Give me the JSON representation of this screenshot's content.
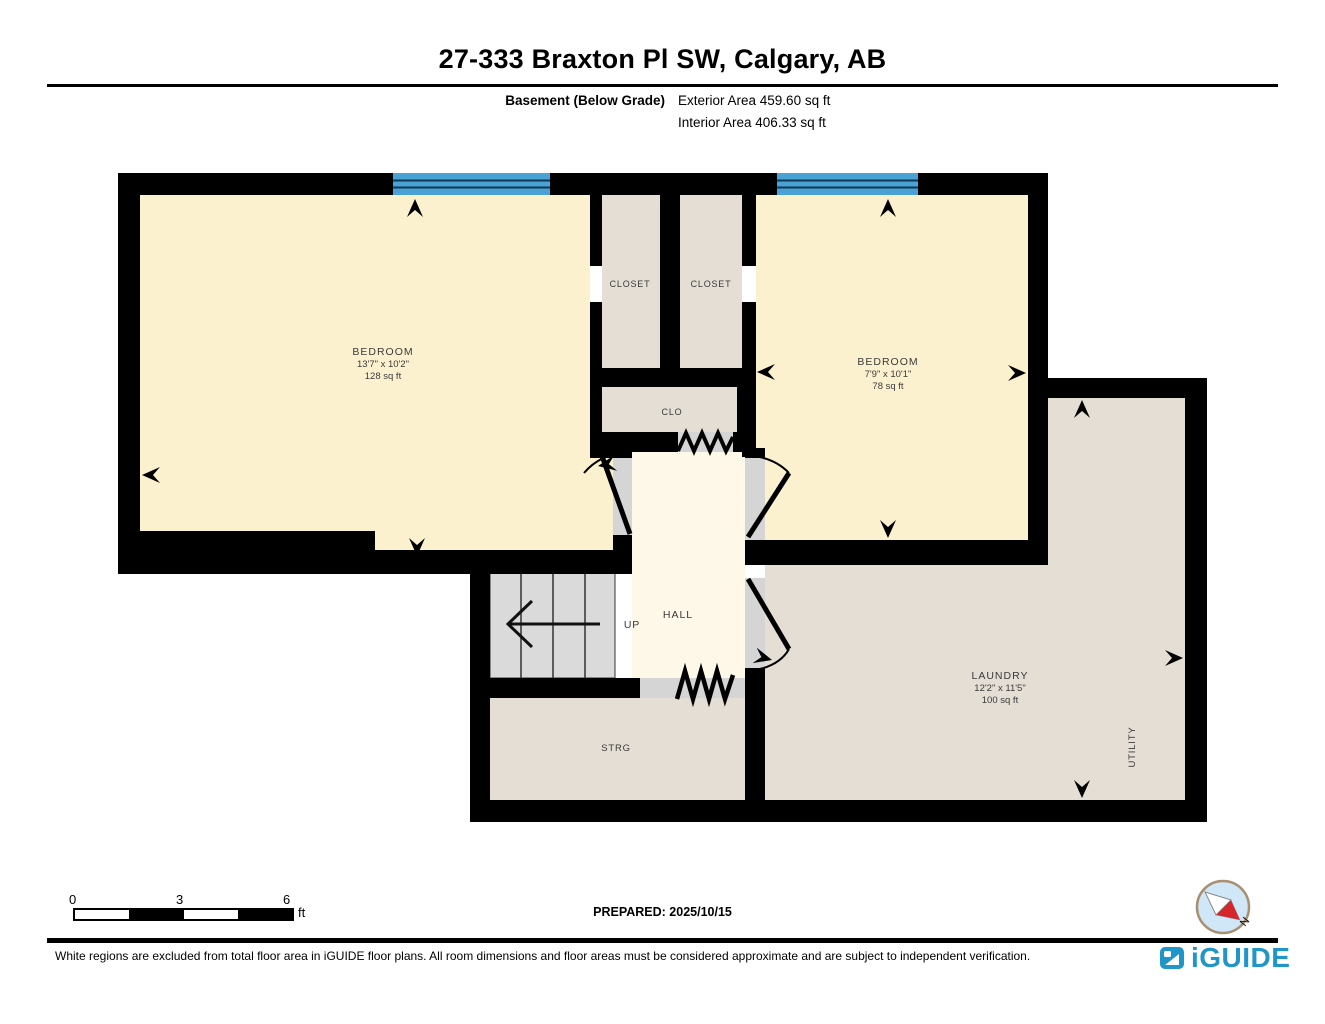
{
  "header": {
    "title": "27-333 Braxton Pl SW, Calgary, AB",
    "floor_label": "Basement (Below Grade)",
    "exterior_area": "Exterior Area 459.60 sq ft",
    "interior_area": "Interior Area 406.33 sq ft"
  },
  "rooms": {
    "bedroom1": {
      "name": "BEDROOM",
      "dimensions": "13'7\" x 10'2\"",
      "area": "128 sq ft"
    },
    "bedroom2": {
      "name": "BEDROOM",
      "dimensions": "7'9\" x 10'1\"",
      "area": "78 sq ft"
    },
    "closet1": {
      "name": "CLOSET"
    },
    "closet2": {
      "name": "CLOSET"
    },
    "clo": {
      "name": "CLO"
    },
    "hall": {
      "name": "HALL"
    },
    "stairs": {
      "label": "UP"
    },
    "strg": {
      "name": "STRG"
    },
    "laundry": {
      "name": "LAUNDRY",
      "dimensions": "12'2\" x 11'5\"",
      "area": "100 sq ft"
    },
    "utility": {
      "name": "UTILITY"
    }
  },
  "scale_bar": {
    "start": "0",
    "mid": "3",
    "end": "6",
    "unit": "ft"
  },
  "prepared_label": "PREPARED: 2025/10/15",
  "compass": {
    "north_label": "N"
  },
  "footer": {
    "disclaimer": "White regions are excluded from total floor area in iGUIDE floor plans. All room dimensions and floor areas must be considered approximate and are subject to independent verification.",
    "brand": "iGUIDE"
  },
  "colors": {
    "room_cream": "#fcf1cf",
    "hall_cream": "#fdf8e8",
    "service_beige": "#e4ded4",
    "threshold_gray": "#d5d5d5",
    "stairs_gray": "#dadada",
    "wall_black": "#000000",
    "window_blue": "#4aa1d6",
    "brand_blue": "#2096c8",
    "compass_red": "#d6252b"
  }
}
